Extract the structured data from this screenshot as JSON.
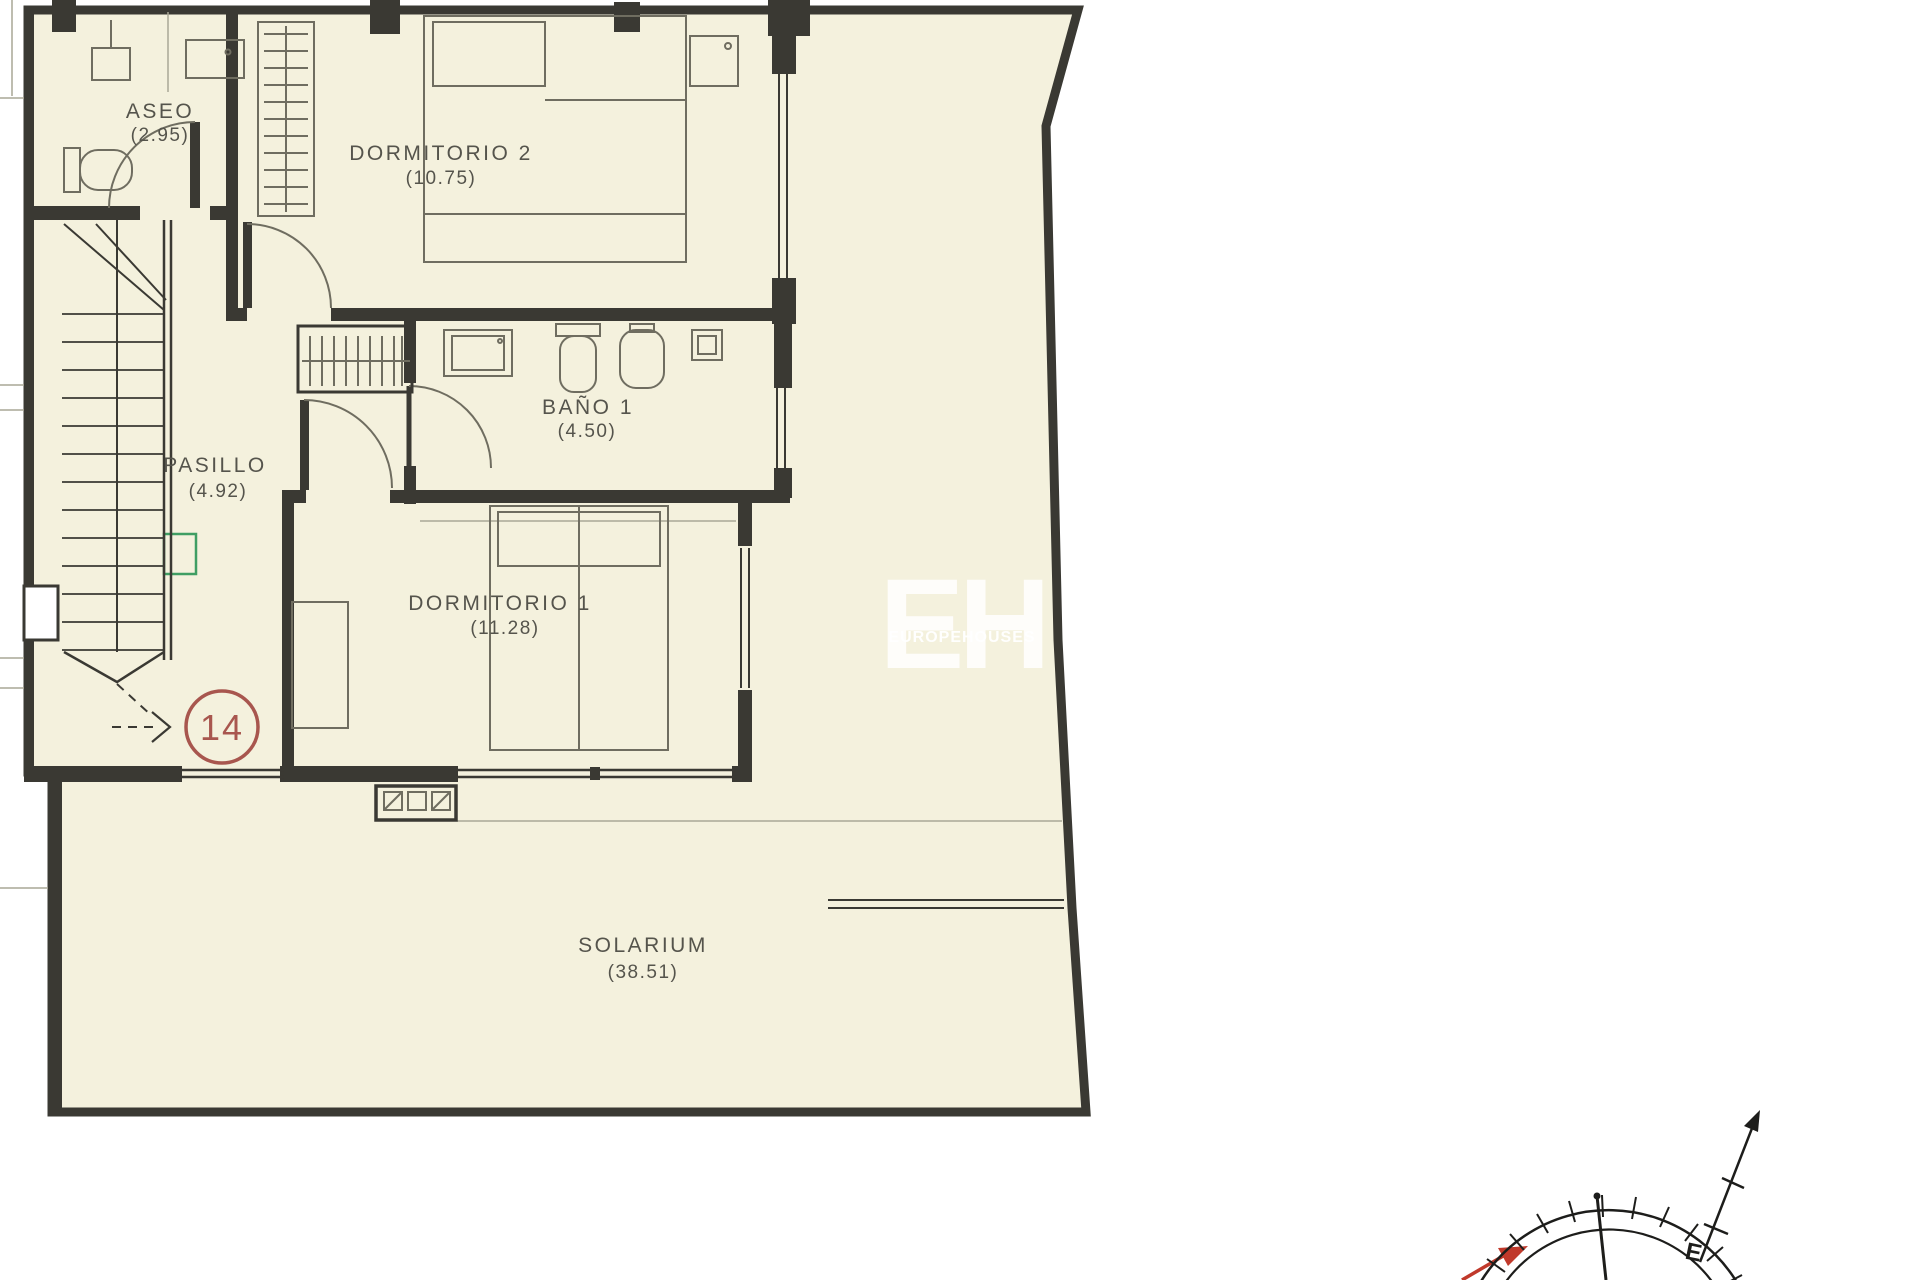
{
  "floor_plan": {
    "rooms": [
      {
        "name": "ASEO",
        "area": "(2.95)"
      },
      {
        "name": "DORMITORIO 2",
        "area": "(10.75)"
      },
      {
        "name": "BAÑO 1",
        "area": "(4.50)"
      },
      {
        "name": "PASILLO",
        "area": "(4.92)"
      },
      {
        "name": "DORMITORIO 1",
        "area": "(11.28)"
      },
      {
        "name": "SOLARIUM",
        "area": "(38.51)"
      }
    ],
    "unit_number": "14",
    "watermark": {
      "initials": "EH",
      "text": "EUROPEHOUSES"
    },
    "compass": {
      "letter": "E"
    },
    "colors": {
      "paper": "#f4f1dd",
      "wall": "#3a3933",
      "furniture_line": "#6f6d60",
      "label_text": "#55544c",
      "unit_circle": "#a8564e",
      "window_marker": "#3f9e63",
      "compass_arrow": "#c0392b"
    }
  }
}
